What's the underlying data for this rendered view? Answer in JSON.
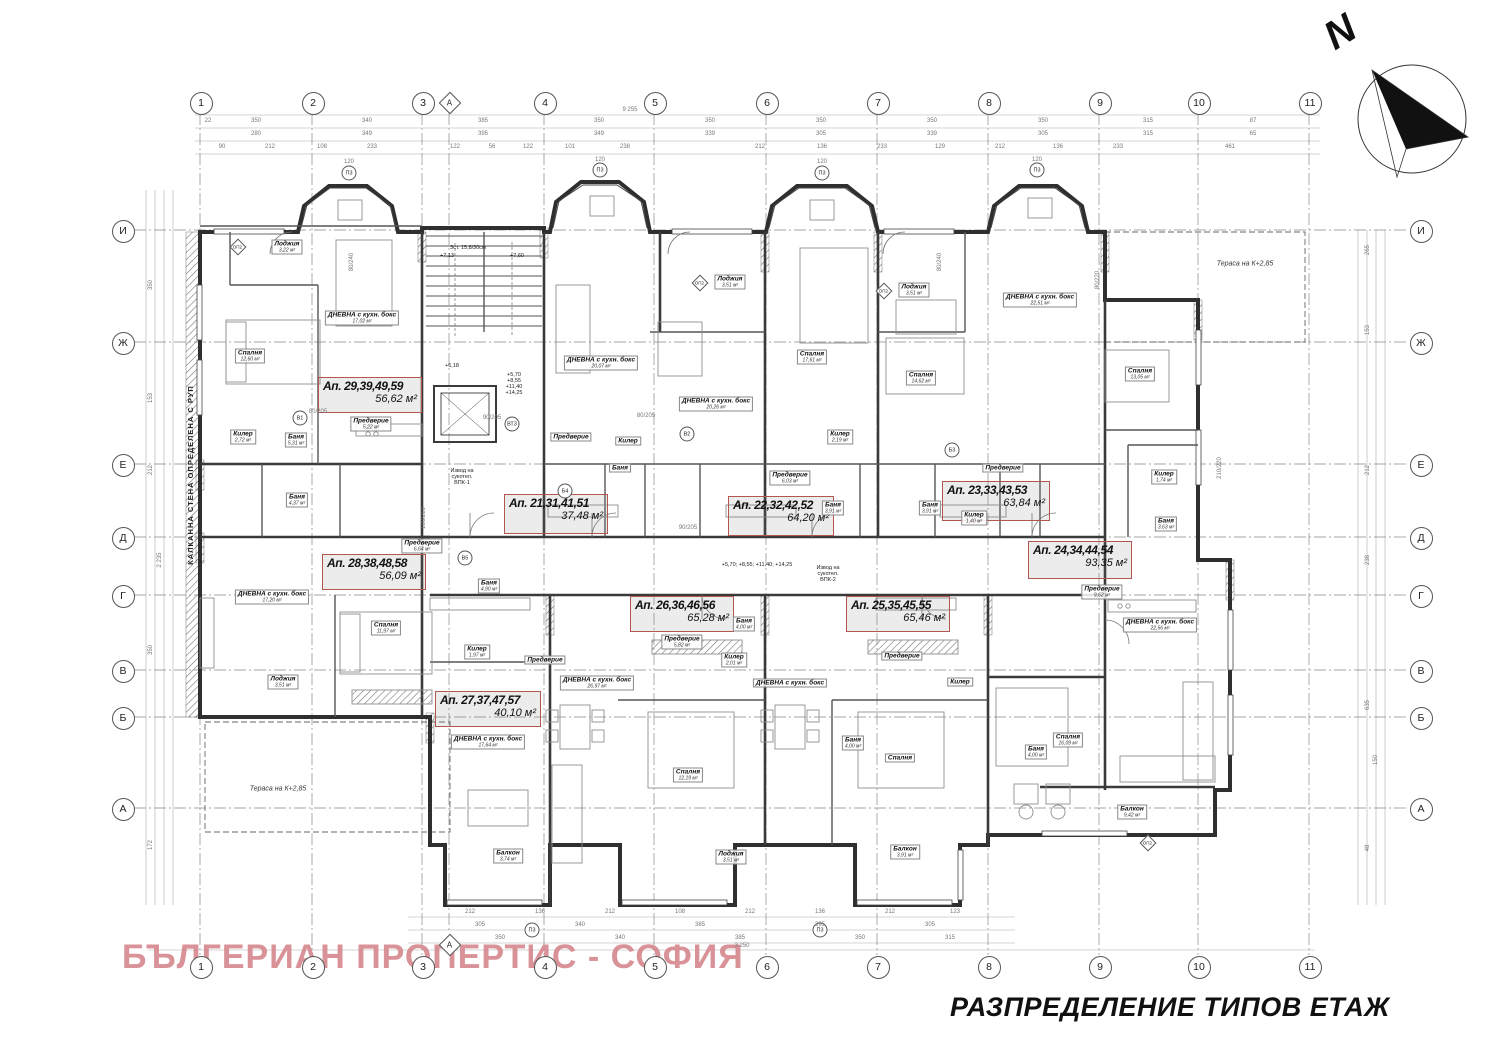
{
  "title": "РАЗПРЕДЕЛЕНИЕ ТИПОВ ЕТАЖ",
  "watermark": "БЪЛГЕРИАН ПРОПЕРТИС - СОФИЯ",
  "compass": {
    "label": "N"
  },
  "terraces": [
    {
      "label": "Тераса на К+2,85",
      "x": 278,
      "y": 789
    },
    {
      "label": "Тераса на К+2,85",
      "x": 1245,
      "y": 264
    }
  ],
  "grid": {
    "top_y": 102,
    "bottom_y": 966,
    "left_x": 122,
    "right_x": 1420,
    "aux_bottom_y": 944,
    "columns": [
      {
        "label": "1",
        "x": 200
      },
      {
        "label": "2",
        "x": 312
      },
      {
        "label": "3",
        "x": 422
      },
      {
        "label": "4",
        "x": 544
      },
      {
        "label": "5",
        "x": 654
      },
      {
        "label": "6",
        "x": 766
      },
      {
        "label": "7",
        "x": 877
      },
      {
        "label": "8",
        "x": 988
      },
      {
        "label": "9",
        "x": 1099
      },
      {
        "label": "10",
        "x": 1198
      },
      {
        "label": "11",
        "x": 1309
      }
    ],
    "aux": {
      "label": "А",
      "x": 449
    },
    "rows": [
      {
        "label": "И",
        "y": 230
      },
      {
        "label": "Ж",
        "y": 342
      },
      {
        "label": "Е",
        "y": 464
      },
      {
        "label": "Д",
        "y": 537
      },
      {
        "label": "Г",
        "y": 595
      },
      {
        "label": "В",
        "y": 670
      },
      {
        "label": "Б",
        "y": 717
      },
      {
        "label": "А",
        "y": 808
      }
    ]
  },
  "apartments": [
    {
      "name": "Ап. 29,39,49,59",
      "area": "56,62 м²",
      "x": 318,
      "y": 377,
      "w": 104,
      "h": 36
    },
    {
      "name": "Ап. 21,31,41,51",
      "area": "37,48 м²",
      "x": 504,
      "y": 494,
      "w": 104,
      "h": 40
    },
    {
      "name": "Ап. 22,32,42,52",
      "area": "64,20 м²",
      "x": 728,
      "y": 496,
      "w": 106,
      "h": 40
    },
    {
      "name": "Ап. 23,33,43,53",
      "area": "63,84 м²",
      "x": 942,
      "y": 481,
      "w": 108,
      "h": 40
    },
    {
      "name": "Ап. 24,34,44,54",
      "area": "93,35 м²",
      "x": 1028,
      "y": 541,
      "w": 104,
      "h": 38
    },
    {
      "name": "Ап. 28,38,48,58",
      "area": "56,09 м²",
      "x": 322,
      "y": 554,
      "w": 104,
      "h": 36
    },
    {
      "name": "Ап. 26,36,46,56",
      "area": "65,28 м²",
      "x": 630,
      "y": 596,
      "w": 104,
      "h": 36
    },
    {
      "name": "Ап. 25,35,45,55",
      "area": "65,46 м²",
      "x": 846,
      "y": 596,
      "w": 104,
      "h": 36
    },
    {
      "name": "Ап. 27,37,47,57",
      "area": "40,10 м²",
      "x": 435,
      "y": 691,
      "w": 106,
      "h": 36
    }
  ],
  "rooms": [
    {
      "label": "Лоджия",
      "area": "3,22 м²",
      "x": 287,
      "y": 247
    },
    {
      "label": "Спалня",
      "area": "12,60 м²",
      "x": 250,
      "y": 356
    },
    {
      "label": "ДНЕВНА с кухн. бокс",
      "area": "17,02 м²",
      "x": 362,
      "y": 318
    },
    {
      "label": "Килер",
      "area": "2,72 м²",
      "x": 243,
      "y": 437
    },
    {
      "label": "Баня",
      "area": "5,31 м²",
      "x": 296,
      "y": 440
    },
    {
      "label": "Предверие",
      "area": "5,22 м²",
      "x": 371,
      "y": 424
    },
    {
      "label": "ДНЕВНА с кухн. бокс",
      "area": "20,07 м²",
      "x": 601,
      "y": 363
    },
    {
      "label": "Предверие",
      "area": "",
      "x": 571,
      "y": 437
    },
    {
      "label": "Килер",
      "area": "",
      "x": 628,
      "y": 441
    },
    {
      "label": "Баня",
      "area": "",
      "x": 620,
      "y": 468
    },
    {
      "label": "Баня",
      "area": "4,37 м²",
      "x": 297,
      "y": 500
    },
    {
      "label": "ДНЕВНА с кухн. бокс",
      "area": "17,20 м²",
      "x": 272,
      "y": 597
    },
    {
      "label": "Спалня",
      "area": "11,97 м²",
      "x": 386,
      "y": 628
    },
    {
      "label": "Лоджия",
      "area": "3,51 м²",
      "x": 283,
      "y": 682
    },
    {
      "label": "Предверие",
      "area": "6,64 м²",
      "x": 422,
      "y": 546
    },
    {
      "label": "Баня",
      "area": "4,90 м²",
      "x": 489,
      "y": 586
    },
    {
      "label": "Килер",
      "area": "1,97 м²",
      "x": 477,
      "y": 652
    },
    {
      "label": "Предверие",
      "area": "",
      "x": 545,
      "y": 660
    },
    {
      "label": "Лоджия",
      "area": "3,51 м²",
      "x": 730,
      "y": 282
    },
    {
      "label": "ДНЕВНА с кухн. бокс",
      "area": "20,26 м²",
      "x": 716,
      "y": 404
    },
    {
      "label": "Спалня",
      "area": "17,61 м²",
      "x": 812,
      "y": 357
    },
    {
      "label": "Килер",
      "area": "2,19 м²",
      "x": 840,
      "y": 437
    },
    {
      "label": "Предверие",
      "area": "6,03 м²",
      "x": 790,
      "y": 478
    },
    {
      "label": "Баня",
      "area": "3,91 м²",
      "x": 833,
      "y": 508
    },
    {
      "label": "Баня",
      "area": "3,91 м²",
      "x": 930,
      "y": 508
    },
    {
      "label": "Лоджия",
      "area": "3,51 м²",
      "x": 914,
      "y": 290
    },
    {
      "label": "ДНЕВНА с кухн. бокс",
      "area": "22,51 м²",
      "x": 1040,
      "y": 300
    },
    {
      "label": "Спалня",
      "area": "14,62 м²",
      "x": 921,
      "y": 378
    },
    {
      "label": "Предверие",
      "area": "",
      "x": 1003,
      "y": 468
    },
    {
      "label": "Килер",
      "area": "1,40 м²",
      "x": 974,
      "y": 518
    },
    {
      "label": "Спалня",
      "area": "13,05 м²",
      "x": 1140,
      "y": 374
    },
    {
      "label": "Килер",
      "area": "1,74 м²",
      "x": 1164,
      "y": 477
    },
    {
      "label": "Баня",
      "area": "3,63 м²",
      "x": 1166,
      "y": 524
    },
    {
      "label": "Предверие",
      "area": "9,62 м²",
      "x": 1102,
      "y": 592
    },
    {
      "label": "ДНЕВНА с кухн. бокс",
      "area": "22,56 м²",
      "x": 1160,
      "y": 625
    },
    {
      "label": "Спалня",
      "area": "16,09 м²",
      "x": 1068,
      "y": 740
    },
    {
      "label": "Балкон",
      "area": "9,42 м²",
      "x": 1132,
      "y": 812
    },
    {
      "label": "Баня",
      "area": "4,00 м²",
      "x": 1036,
      "y": 752
    },
    {
      "label": "ДНЕВНА с кухн. бокс",
      "area": "26,97 м²",
      "x": 597,
      "y": 683
    },
    {
      "label": "Спалня",
      "area": "12,19 м²",
      "x": 688,
      "y": 775
    },
    {
      "label": "Лоджия",
      "area": "3,51 м²",
      "x": 731,
      "y": 857
    },
    {
      "label": "Предверие",
      "area": "5,82 м²",
      "x": 682,
      "y": 642
    },
    {
      "label": "Килер",
      "area": "2,01 м²",
      "x": 734,
      "y": 660
    },
    {
      "label": "Баня",
      "area": "4,00 м²",
      "x": 744,
      "y": 624
    },
    {
      "label": "ДНЕВНА с кухн. бокс",
      "area": "17,64 м²",
      "x": 488,
      "y": 742
    },
    {
      "label": "Балкон",
      "area": "3,74 м²",
      "x": 508,
      "y": 856
    },
    {
      "label": "ДНЕВНА с кухн. бокс",
      "area": "",
      "x": 790,
      "y": 683
    },
    {
      "label": "Спалня",
      "area": "",
      "x": 900,
      "y": 758
    },
    {
      "label": "Предверие",
      "area": "",
      "x": 902,
      "y": 656
    },
    {
      "label": "Килер",
      "area": "",
      "x": 960,
      "y": 682
    },
    {
      "label": "Баня",
      "area": "4,00 м²",
      "x": 853,
      "y": 743
    },
    {
      "label": "Балкон",
      "area": "3,91 м²",
      "x": 905,
      "y": 852
    }
  ],
  "annotations": [
    {
      "t": "+7,13",
      "x": 447,
      "y": 256
    },
    {
      "t": "+7,60",
      "x": 517,
      "y": 256
    },
    {
      "t": "+6,18",
      "x": 452,
      "y": 366
    },
    {
      "t": "+5,70\n+8,55\n+11,40\n+14,25",
      "x": 514,
      "y": 384
    },
    {
      "t": "+5,70; +8,55; +11,40; +14,25",
      "x": 757,
      "y": 565
    },
    {
      "t": "Извод на\nсукотел.\nВПК-1",
      "x": 462,
      "y": 477
    },
    {
      "t": "Извод на\nсукотел.\nВПК-2",
      "x": 828,
      "y": 574
    },
    {
      "t": "КАЛКАННА СТЕНА ОПРЕДЕЛЕНА С РУП",
      "x": 191,
      "y": 475,
      "r": -90
    },
    {
      "t": "3ст. 15,8/30см",
      "x": 468,
      "y": 248
    }
  ],
  "fittings": [
    {
      "t": "П3",
      "x": 349,
      "y": 173,
      "s": "circle"
    },
    {
      "t": "П3",
      "x": 600,
      "y": 170,
      "s": "circle"
    },
    {
      "t": "П3",
      "x": 822,
      "y": 173,
      "s": "circle"
    },
    {
      "t": "П3",
      "x": 1037,
      "y": 170,
      "s": "circle"
    },
    {
      "t": "П3",
      "x": 532,
      "y": 930,
      "s": "circle"
    },
    {
      "t": "П3",
      "x": 820,
      "y": 930,
      "s": "circle"
    },
    {
      "t": "ВТ3",
      "x": 512,
      "y": 424,
      "s": "circle"
    },
    {
      "t": "В1",
      "x": 300,
      "y": 418,
      "s": "circle"
    },
    {
      "t": "В2",
      "x": 687,
      "y": 434,
      "s": "circle"
    },
    {
      "t": "Б3",
      "x": 952,
      "y": 450,
      "s": "circle"
    },
    {
      "t": "Б4",
      "x": 565,
      "y": 491,
      "s": "circle"
    },
    {
      "t": "В5",
      "x": 465,
      "y": 558,
      "s": "circle"
    },
    {
      "t": "ОП2",
      "x": 238,
      "y": 247,
      "s": "diamond"
    },
    {
      "t": "ОП2",
      "x": 700,
      "y": 283,
      "s": "diamond"
    },
    {
      "t": "ОП2",
      "x": 884,
      "y": 291,
      "s": "diamond"
    },
    {
      "t": "ОП2",
      "x": 1148,
      "y": 843,
      "s": "diamond"
    }
  ],
  "dims": [
    {
      "t": "22",
      "x": 208,
      "y": 121
    },
    {
      "t": "350",
      "x": 256,
      "y": 121
    },
    {
      "t": "340",
      "x": 367,
      "y": 121
    },
    {
      "t": "385",
      "x": 483,
      "y": 121
    },
    {
      "t": "350",
      "x": 599,
      "y": 121
    },
    {
      "t": "350",
      "x": 710,
      "y": 121
    },
    {
      "t": "350",
      "x": 821,
      "y": 121
    },
    {
      "t": "350",
      "x": 932,
      "y": 121
    },
    {
      "t": "350",
      "x": 1043,
      "y": 121
    },
    {
      "t": "315",
      "x": 1148,
      "y": 121
    },
    {
      "t": "87",
      "x": 1253,
      "y": 121
    },
    {
      "t": "9 255",
      "x": 630,
      "y": 110
    },
    {
      "t": "280",
      "x": 256,
      "y": 134
    },
    {
      "t": "349",
      "x": 367,
      "y": 134
    },
    {
      "t": "395",
      "x": 483,
      "y": 134
    },
    {
      "t": "349",
      "x": 599,
      "y": 134
    },
    {
      "t": "339",
      "x": 710,
      "y": 134
    },
    {
      "t": "305",
      "x": 821,
      "y": 134
    },
    {
      "t": "339",
      "x": 932,
      "y": 134
    },
    {
      "t": "305",
      "x": 1043,
      "y": 134
    },
    {
      "t": "315",
      "x": 1148,
      "y": 134
    },
    {
      "t": "65",
      "x": 1253,
      "y": 134
    },
    {
      "t": "90",
      "x": 222,
      "y": 147
    },
    {
      "t": "212",
      "x": 270,
      "y": 147
    },
    {
      "t": "108",
      "x": 322,
      "y": 147
    },
    {
      "t": "233",
      "x": 372,
      "y": 147
    },
    {
      "t": "122",
      "x": 455,
      "y": 147
    },
    {
      "t": "56",
      "x": 492,
      "y": 147
    },
    {
      "t": "122",
      "x": 528,
      "y": 147
    },
    {
      "t": "101",
      "x": 570,
      "y": 147
    },
    {
      "t": "238",
      "x": 625,
      "y": 147
    },
    {
      "t": "212",
      "x": 760,
      "y": 147
    },
    {
      "t": "136",
      "x": 822,
      "y": 147
    },
    {
      "t": "233",
      "x": 882,
      "y": 147
    },
    {
      "t": "129",
      "x": 940,
      "y": 147
    },
    {
      "t": "212",
      "x": 1000,
      "y": 147
    },
    {
      "t": "136",
      "x": 1058,
      "y": 147
    },
    {
      "t": "233",
      "x": 1118,
      "y": 147
    },
    {
      "t": "461",
      "x": 1230,
      "y": 147
    },
    {
      "t": "120",
      "x": 349,
      "y": 162
    },
    {
      "t": "120",
      "x": 600,
      "y": 160
    },
    {
      "t": "120",
      "x": 822,
      "y": 162
    },
    {
      "t": "120",
      "x": 1037,
      "y": 160
    },
    {
      "t": "212",
      "x": 470,
      "y": 912
    },
    {
      "t": "136",
      "x": 540,
      "y": 912
    },
    {
      "t": "212",
      "x": 610,
      "y": 912
    },
    {
      "t": "108",
      "x": 680,
      "y": 912
    },
    {
      "t": "212",
      "x": 750,
      "y": 912
    },
    {
      "t": "136",
      "x": 820,
      "y": 912
    },
    {
      "t": "212",
      "x": 890,
      "y": 912
    },
    {
      "t": "123",
      "x": 955,
      "y": 912
    },
    {
      "t": "305",
      "x": 480,
      "y": 925
    },
    {
      "t": "340",
      "x": 580,
      "y": 925
    },
    {
      "t": "385",
      "x": 700,
      "y": 925
    },
    {
      "t": "395",
      "x": 820,
      "y": 925
    },
    {
      "t": "305",
      "x": 930,
      "y": 925
    },
    {
      "t": "350",
      "x": 500,
      "y": 938
    },
    {
      "t": "340",
      "x": 620,
      "y": 938
    },
    {
      "t": "385",
      "x": 740,
      "y": 938
    },
    {
      "t": "350",
      "x": 860,
      "y": 938
    },
    {
      "t": "315",
      "x": 950,
      "y": 938
    },
    {
      "t": "3 250",
      "x": 742,
      "y": 946
    },
    {
      "t": "350",
      "x": 151,
      "y": 285,
      "r": 1
    },
    {
      "t": "153",
      "x": 151,
      "y": 398,
      "r": 1
    },
    {
      "t": "212",
      "x": 151,
      "y": 470,
      "r": 1
    },
    {
      "t": "2 235",
      "x": 160,
      "y": 560,
      "r": 1
    },
    {
      "t": "350",
      "x": 151,
      "y": 650,
      "r": 1
    },
    {
      "t": "172",
      "x": 151,
      "y": 845,
      "r": 1
    },
    {
      "t": "265",
      "x": 1368,
      "y": 250,
      "r": 1
    },
    {
      "t": "153",
      "x": 1368,
      "y": 330,
      "r": 1
    },
    {
      "t": "212",
      "x": 1368,
      "y": 470,
      "r": 1
    },
    {
      "t": "238",
      "x": 1368,
      "y": 560,
      "r": 1
    },
    {
      "t": "635",
      "x": 1368,
      "y": 705,
      "r": 1
    },
    {
      "t": "150",
      "x": 1376,
      "y": 760,
      "r": 1
    },
    {
      "t": "48",
      "x": 1368,
      "y": 848,
      "r": 1
    },
    {
      "t": "210/220",
      "x": 1220,
      "y": 468,
      "r": 1
    },
    {
      "t": "80/240",
      "x": 352,
      "y": 262,
      "r": 1
    },
    {
      "t": "80/205",
      "x": 318,
      "y": 412
    },
    {
      "t": "90/205",
      "x": 492,
      "y": 418
    },
    {
      "t": "100/210",
      "x": 424,
      "y": 518,
      "r": 1
    },
    {
      "t": "80/205",
      "x": 646,
      "y": 416
    },
    {
      "t": "90/205",
      "x": 688,
      "y": 528
    },
    {
      "t": "80/220",
      "x": 1098,
      "y": 280,
      "r": 1
    },
    {
      "t": "80/240",
      "x": 940,
      "y": 262,
      "r": 1
    }
  ]
}
